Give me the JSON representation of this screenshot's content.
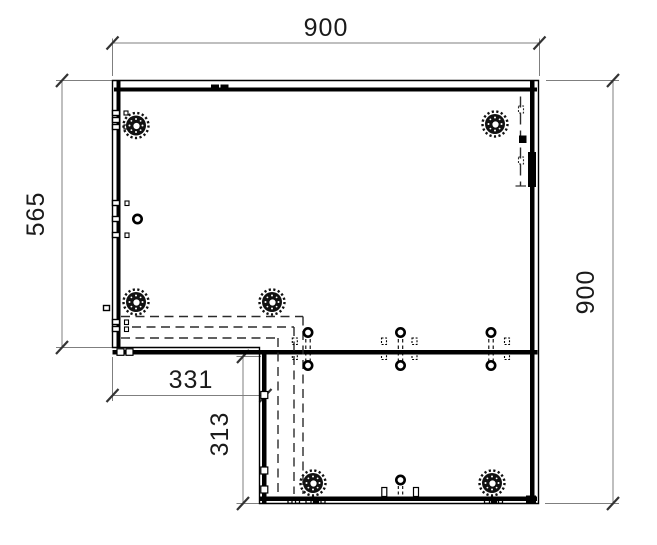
{
  "drawing": {
    "title": "l-shaped-corner-panel-drilling-drawing",
    "dimensions": {
      "overall_width": "900",
      "left_height": "565",
      "right_height": "900",
      "notch_width": "331",
      "notch_depth": "313"
    },
    "symbols": {
      "cam_lock": "eccentric-cam-fitting",
      "drill_hole": "bold-ring-hole",
      "dowel_mark": "edge-dowel-symbol",
      "hidden_edge": "dashed-hidden-line"
    },
    "colors": {
      "background": "#ffffff",
      "outline": "#000000",
      "dimension_line": "#7f7f7f",
      "tick": "#333333",
      "text": "#1a1a1a",
      "dashed": "#2b2b2b"
    }
  }
}
